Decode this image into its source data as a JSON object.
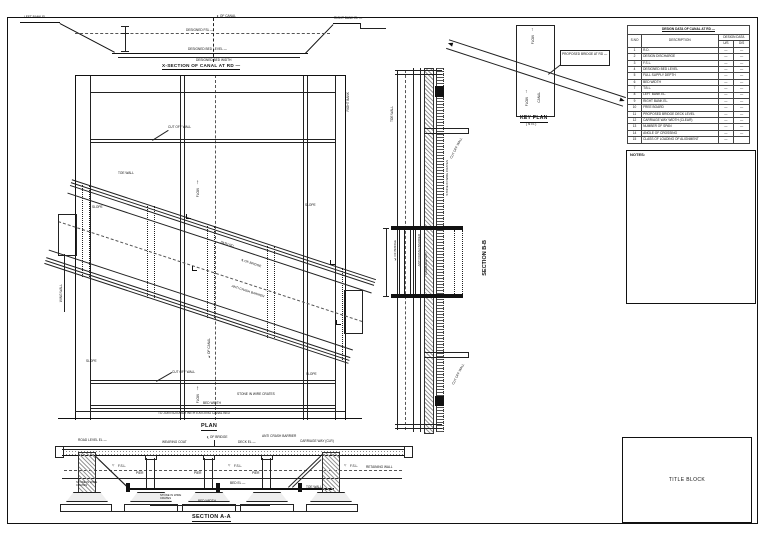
{
  "xsection": {
    "title": "X-SECTION OF CANAL AT RD —",
    "left_bank": "LEFT BANK EL —",
    "right_bank": "RIGHT BANK EL —",
    "cl_canal": "℄ OF CANAL",
    "designed_fsl": "DESIGNED FSL —",
    "designed_bed_level": "DESIGNED BED LEVEL —",
    "designed_bed_width": "DESIGNED BED WIDTH"
  },
  "plan": {
    "title": "PLAN",
    "cut_off_wall": "CUT OFF WALL",
    "toe_wall": "TOE WALL",
    "slope": "SLOPE",
    "flow": "FLOW",
    "flow_arrow": "↑",
    "cl_canal": "℄ OF CANAL",
    "cl_bridge": "℄ OF BRIDGE",
    "path_rd": "PATH RD.",
    "anti_crash_barrier": "ANTI CRASH BARRIER",
    "stone_crates": "STONE IN WIRE CRATES",
    "bed_width": "BED WIDTH",
    "join_note": "TO JOIN SUITABLY WITH EXISTING CANAL BED",
    "right_bank_v": "RIGHT BANK",
    "wing_wall": "WING WALL"
  },
  "keyplan": {
    "title": "KEY PLAN",
    "nts": "( NTS )",
    "flow": "FLOW",
    "flow_arrow": "↑",
    "canal": "CANAL",
    "callout": "PROPOSED BRIDGE AT RD —"
  },
  "section_bb": {
    "title": "SECTION B-B",
    "toe_wall": "TOE WALL",
    "cut_off_wall": "CUT OFF WALL",
    "stone_crates": "STONE IN WIRE CRATES",
    "cl_bridge": "℄ OF BRIDGE",
    "anti_crash": "ANTI CRASH BARRIER",
    "carriage_way": "CARRIAGE WAY"
  },
  "section_aa": {
    "title": "SECTION A-A",
    "road_level": "ROAD LEVEL EL —",
    "wearing_coat": "WEARING COAT",
    "cl_bridge": "℄ OF BRIDGE",
    "deck_el": "DECK EL —",
    "anti_crash": "ANTI CRASH BARRIER",
    "carriage_way": "CARRIAGE WAY (CLR)",
    "fsl_mark": "▽",
    "fsl": "F.S.L.",
    "pier": "PIER",
    "bed_el": "BED EL —",
    "toe_wall": "TOE WALL",
    "retaining_wall": "RETAINING WALL",
    "stone_crates": "STONE IN WIRE CRATES",
    "bed_width": "BED WIDTH"
  },
  "design_table": {
    "title": "DESIGN DATA OF CANAL AT RD —",
    "col_sno": "S.NO",
    "col_desc": "DESCRIPTION",
    "col_data": "DESIGN DATA",
    "col_us": "U/S",
    "col_ds": "D/S",
    "rows": [
      {
        "no": "1",
        "desc": "R.D.",
        "us": "—",
        "ds": "—"
      },
      {
        "no": "2",
        "desc": "DESIGN DISCHARGE",
        "us": "—",
        "ds": "—"
      },
      {
        "no": "3",
        "desc": "F.S.L.",
        "us": "—",
        "ds": "—"
      },
      {
        "no": "4",
        "desc": "DESIGNED BED LEVEL",
        "us": "—",
        "ds": "—"
      },
      {
        "no": "5",
        "desc": "FULL SUPPLY DEPTH",
        "us": "—",
        "ds": "—"
      },
      {
        "no": "6",
        "desc": "BED WIDTH",
        "us": "—",
        "ds": "—"
      },
      {
        "no": "7",
        "desc": "T.B.L.",
        "us": "—",
        "ds": "—"
      },
      {
        "no": "8",
        "desc": "LEFT BANK EL.",
        "us": "—",
        "ds": "—"
      },
      {
        "no": "9",
        "desc": "RIGHT BANK EL.",
        "us": "—",
        "ds": "—"
      },
      {
        "no": "10",
        "desc": "FREE BOARD",
        "us": "—",
        "ds": "—"
      },
      {
        "no": "11",
        "desc": "PROPOSED BRIDGE DECK LEVEL",
        "us": "—",
        "ds": "—"
      },
      {
        "no": "12",
        "desc": "CARRIAGE WAY WIDTH (CLEAR)",
        "us": "—",
        "ds": "—"
      },
      {
        "no": "13",
        "desc": "NUMBER OF SPAN",
        "us": "—",
        "ds": "—"
      },
      {
        "no": "14",
        "desc": "ANGLE OF CROSSING",
        "us": "—",
        "ds": "—"
      },
      {
        "no": "15",
        "desc": "CLASS OF LOADING OF ALIGNMENT",
        "us": "—",
        "ds": ""
      }
    ]
  },
  "notes": {
    "heading": "NOTES:"
  },
  "title_block": {
    "label": "TITLE BLOCK"
  }
}
